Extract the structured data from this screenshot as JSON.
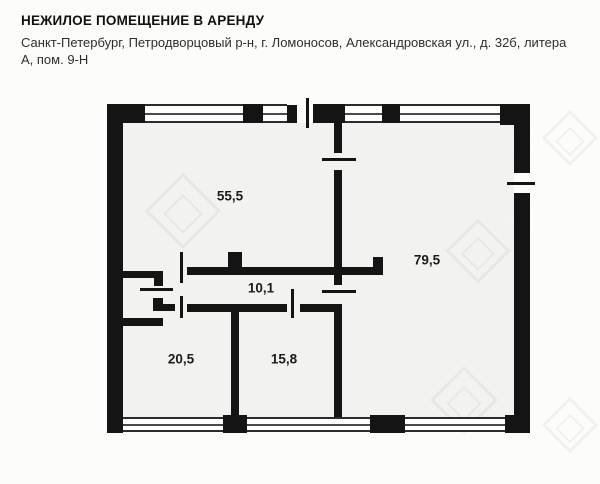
{
  "header": {
    "title": "НЕЖИЛОЕ ПОМЕЩЕНИЕ В АРЕНДУ",
    "address": "Санкт-Петербург, Петродворцовый р-н, г. Ломоносов, Александровская ул., д. 32б, литера А, пом. 9-Н"
  },
  "floorplan": {
    "rooms": [
      {
        "name": "room-55-5",
        "area": "55,5"
      },
      {
        "name": "room-79-5",
        "area": "79,5"
      },
      {
        "name": "corridor-10-1",
        "area": "10,1"
      },
      {
        "name": "room-20-5",
        "area": "20,5"
      },
      {
        "name": "room-15-8",
        "area": "15,8"
      }
    ],
    "colors": {
      "wall": "#141414",
      "floor": "#f2f2f0",
      "background": "#fcfcfb",
      "window_line": "#2b2b2b"
    }
  }
}
